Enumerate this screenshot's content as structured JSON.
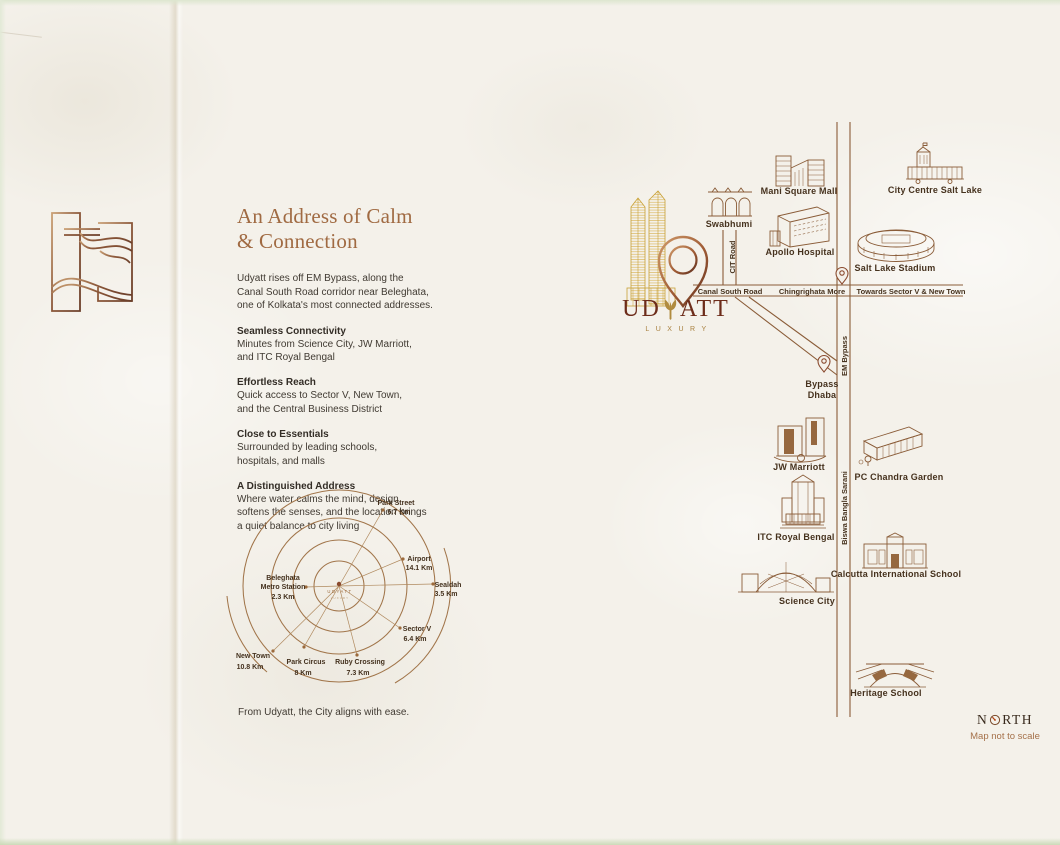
{
  "page": {
    "background": "#f4f1ea",
    "accent_brown": "#8a5c38",
    "title_color": "#a06a42",
    "brand_maroon": "#6d2c1a",
    "gold": "#c9a136"
  },
  "icons": {
    "emblem": "udyatt-abstract-monogram-icon",
    "towers": "udyatt-twin-towers-icon",
    "pin": "location-pin-icon",
    "leaf": "leaf-y-glyph-icon",
    "compass": "compass-rose-icon"
  },
  "intro": {
    "title_lines": [
      "An Address of Calm",
      "& Connection"
    ],
    "lead": [
      "Udyatt rises off EM Bypass, along the",
      "Canal South Road corridor near Beleghata,",
      "one of Kolkata's most connected addresses."
    ],
    "sections": [
      {
        "heading": "Seamless Connectivity",
        "lines": [
          "Minutes from Science City, JW Marriott,",
          "and ITC Royal Bengal"
        ]
      },
      {
        "heading": "Effortless Reach",
        "lines": [
          "Quick access to Sector V, New Town,",
          "and the Central Business District"
        ]
      },
      {
        "heading": "Close to Essentials",
        "lines": [
          "Surrounded by leading schools,",
          "hospitals, and malls"
        ]
      },
      {
        "heading": "A Distinguished Address",
        "lines": [
          "Where water calms the mind, design",
          "softens the senses, and the location brings",
          "a quiet balance to city living"
        ]
      }
    ],
    "closing": "From Udyatt, the City aligns with ease."
  },
  "radial": {
    "center": {
      "name": "UDYATT",
      "tagline": "LUXURY"
    },
    "spokes": [
      {
        "label_lines": [
          "Park Street"
        ],
        "distance": "6.7 Km"
      },
      {
        "label_lines": [
          "Airport"
        ],
        "distance": "14.1 Km"
      },
      {
        "label_lines": [
          "Sealdah"
        ],
        "distance": "3.5 Km"
      },
      {
        "label_lines": [
          "Sector V"
        ],
        "distance": "6.4 Km"
      },
      {
        "label_lines": [
          "Ruby Crossing"
        ],
        "distance": "7.3 Km"
      },
      {
        "label_lines": [
          "Park Circus"
        ],
        "distance": "8 Km"
      },
      {
        "label_lines": [
          "New Town"
        ],
        "distance": "10.8 Km"
      },
      {
        "label_lines": [
          "Beleghata",
          "Metro Station"
        ],
        "distance": "2.3 Km"
      }
    ]
  },
  "brand": {
    "word_start": "UD",
    "word_end": "ATT",
    "tagline": "LUXURY"
  },
  "map": {
    "roads": {
      "canal_south_road": "Canal South Road",
      "chingrighata_more": "Chingrighata More",
      "towards_sector": "Towards Sector V & New Town",
      "cit_road": "CIT Road",
      "em_bypass": "EM Bypass",
      "biswa_bangla_sarani": "Biswa Bangla Sarani"
    },
    "pois": {
      "swabhumi": "Swabhumi",
      "mani_square_mall": "Mani Square Mall",
      "apollo_hospital": "Apollo Hospital",
      "city_centre_salt_lake": "City Centre Salt Lake",
      "salt_lake_stadium": "Salt Lake Stadium",
      "jw_marriott": "JW Marriott",
      "pc_chandra_garden": "PC Chandra Garden",
      "itc_royal_bengal": "ITC Royal Bengal",
      "calcutta_international_school": "Calcutta International School",
      "science_city": "Science City",
      "heritage_school": "Heritage School",
      "bypass_dhaba_line1": "Bypass",
      "bypass_dhaba_line2": "Dhaba"
    }
  },
  "compass": {
    "north_n": "N",
    "north_rth": "RTH",
    "note": "Map not to scale"
  }
}
